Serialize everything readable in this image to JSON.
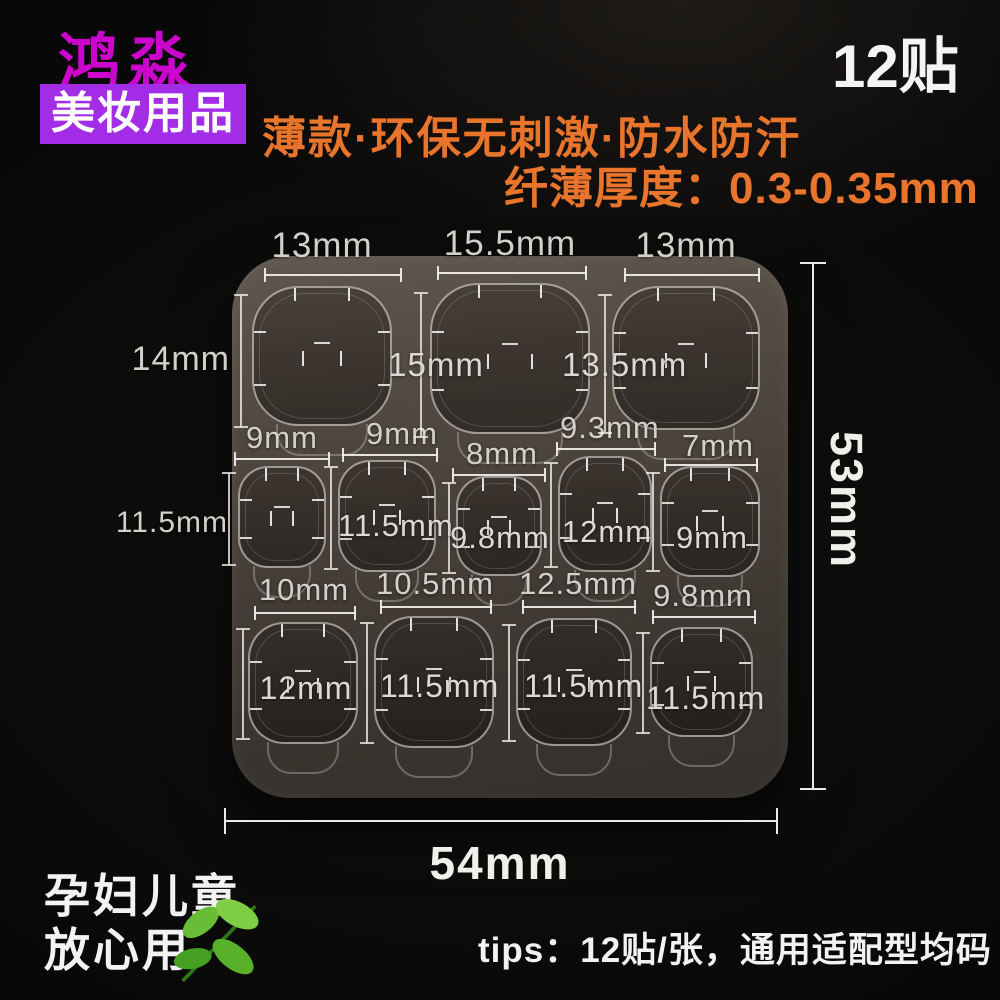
{
  "brand": {
    "name": "鸿淼",
    "badge": "美妆用品"
  },
  "count_badge": "12贴",
  "headline": {
    "line1": "薄款·环保无刺激·防水防汗",
    "line2": "纤薄厚度：0.3-0.35mm"
  },
  "sheet": {
    "overall_width": "54mm",
    "overall_height": "53mm",
    "rows": [
      {
        "stickers": [
          {
            "w": "13mm",
            "h": "14mm"
          },
          {
            "w": "15.5mm",
            "h": "15mm"
          },
          {
            "w": "13mm",
            "h": "13.5mm"
          }
        ]
      },
      {
        "stickers": [
          {
            "w": "9mm",
            "h": "11.5mm"
          },
          {
            "w": "9mm",
            "h": "11.5mm"
          },
          {
            "w": "8mm",
            "h": "9.8mm"
          },
          {
            "w": "9.3mm",
            "h": "12mm"
          },
          {
            "w": "7mm",
            "h": "9mm"
          }
        ]
      },
      {
        "stickers": [
          {
            "w": "10mm",
            "h": "12mm"
          },
          {
            "w": "10.5mm",
            "h": "11.5mm"
          },
          {
            "w": "12.5mm",
            "h": "11.5mm"
          },
          {
            "w": "9.8mm",
            "h": "11.5mm"
          }
        ]
      }
    ]
  },
  "footer": {
    "safety_line1": "孕妇儿童",
    "safety_line2": "放心用",
    "tips": "tips：12贴/张，通用适配型均码"
  },
  "icons": {
    "leaf": "leaf-icon"
  },
  "colors": {
    "brand_magenta": "#cb05cb",
    "badge_purple": "#a32ce6",
    "accent_orange": "#e8752b",
    "leaf_green": "#58b02b",
    "sheet_tone": "#4a433c"
  }
}
